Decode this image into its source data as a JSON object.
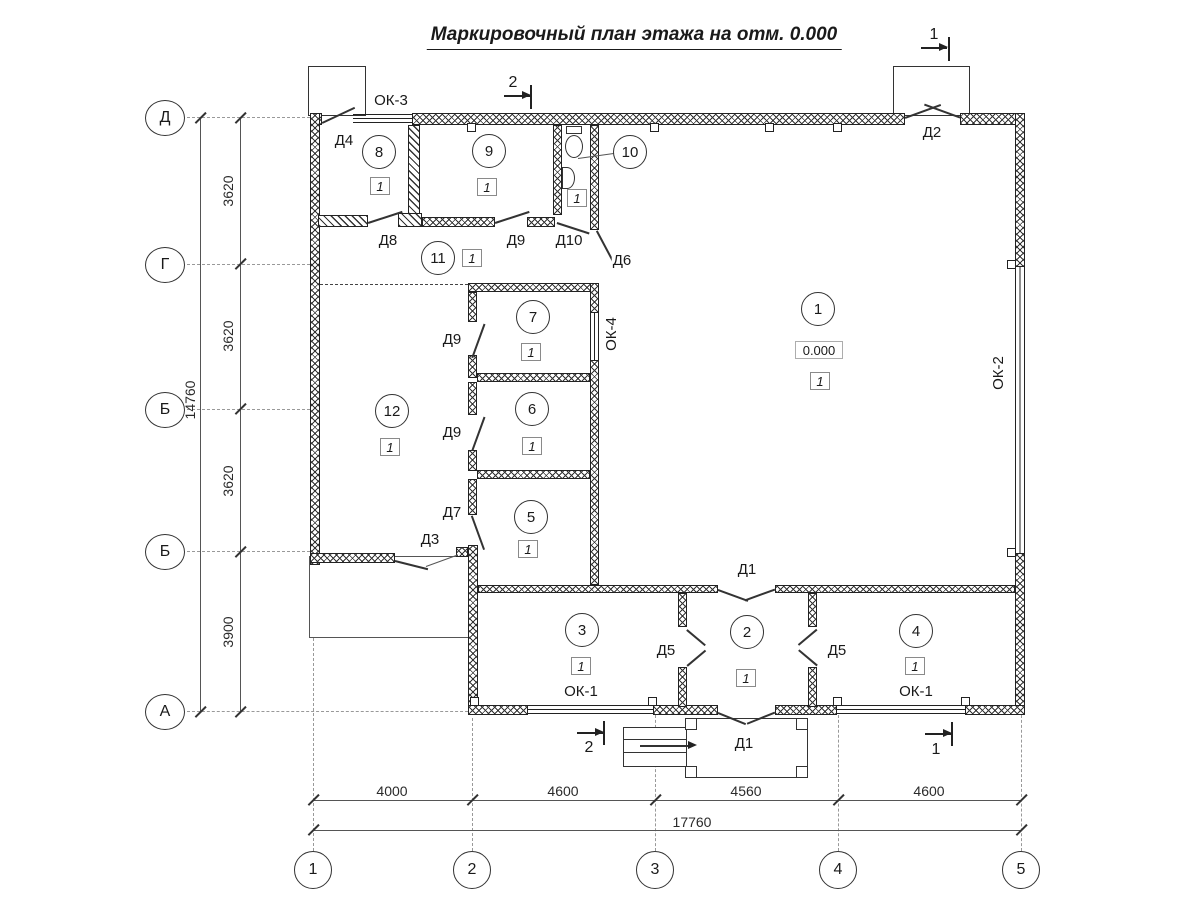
{
  "title": "Маркировочный план этажа на отм. 0.000",
  "section_marks": {
    "s1": "1",
    "s2": "2"
  },
  "axes": {
    "left": [
      "Д",
      "Г",
      "Б",
      "Б",
      "А"
    ],
    "bottom": [
      "1",
      "2",
      "3",
      "4",
      "5"
    ]
  },
  "dims": {
    "left": [
      "3620",
      "3620",
      "3620",
      "3900"
    ],
    "left_total": "14760",
    "bottom": [
      "4000",
      "4600",
      "4560",
      "4600"
    ],
    "bottom_total": "17760"
  },
  "rooms": [
    {
      "number": "1",
      "marker": "1",
      "elevation": "0.000"
    },
    {
      "number": "2",
      "marker": "1"
    },
    {
      "number": "3",
      "marker": "1"
    },
    {
      "number": "4",
      "marker": "1"
    },
    {
      "number": "5",
      "marker": "1"
    },
    {
      "number": "6",
      "marker": "1"
    },
    {
      "number": "7",
      "marker": "1"
    },
    {
      "number": "8",
      "marker": "1"
    },
    {
      "number": "9",
      "marker": "1"
    },
    {
      "number": "10",
      "marker": "1"
    },
    {
      "number": "11",
      "marker": "1"
    },
    {
      "number": "12",
      "marker": "1"
    }
  ],
  "doors": {
    "d1": "Д1",
    "d2": "Д2",
    "d3": "Д3",
    "d4": "Д4",
    "d5": "Д5",
    "d6": "Д6",
    "d7": "Д7",
    "d8": "Д8",
    "d9": "Д9",
    "d10": "Д10"
  },
  "windows": {
    "ok1": "ОК-1",
    "ok2": "ОК-2",
    "ok3": "ОК-3",
    "ok4": "ОК-4"
  }
}
